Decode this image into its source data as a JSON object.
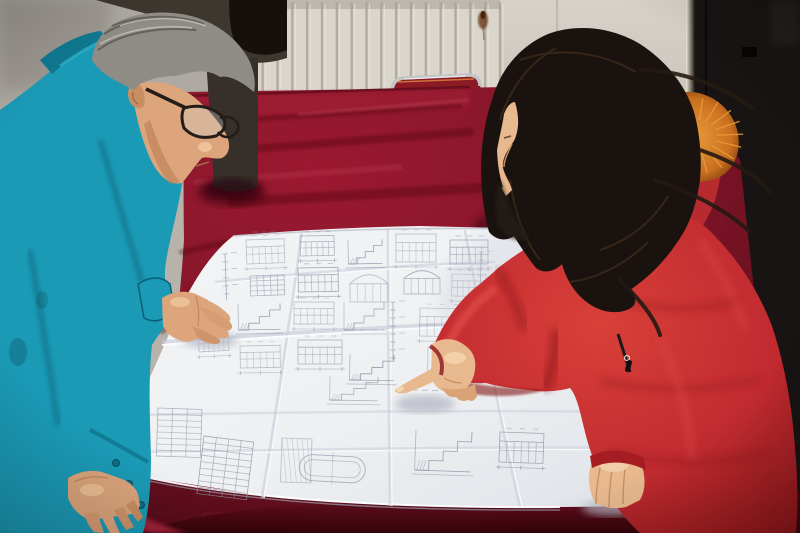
{
  "scene": {
    "kind": "photograph",
    "subjects": [
      "left-worker-teal-jacket",
      "background-worker-dark-jacket",
      "right-worker-red-coat"
    ],
    "action": "reviewing-folded-blueprint-on-red-velvet-table"
  },
  "palette": {
    "wall_left": "#a9a59e",
    "wall_right": "#d0ccc3",
    "wall_line": "#b8b3aa",
    "radiator_base": "#dad6cc",
    "radiator_groove": "#aaa59a",
    "radiator_light": "#e9e5dc",
    "rust": "#6e3f20",
    "door": "#181413",
    "door_edge": "#efe7d4",
    "chair_metal": "#c2c4c6",
    "chair_red": "#8c1a24",
    "chair_glint": "#d8883f",
    "velvet_center": "#9c1930",
    "velvet_edge": "#5a0c1b",
    "velvet_dark": "#3f0711",
    "velvet_mid": "#7e1527",
    "velvet_light": "#c24a5e",
    "velvet_deep": "#350509",
    "edge_bright": "#a1203a",
    "paper": "#eef0f2",
    "paper_shade": "#dfe2e8",
    "crease_shadow": "#c8ccd8",
    "crease_light": "#f9fafc",
    "line": "#8d93a6",
    "teal": "#1b9ab6",
    "teal_light": "#2fb0c9",
    "teal_dark": "#0f7890",
    "teal_deep": "#0a5e74",
    "skin": "#dca57c",
    "skin_light": "#f0c79c",
    "skin_shadow": "#b97a50",
    "hair_gray": "#8f8c86",
    "hair_gray_dark": "#5a5650",
    "hair_black": "#16100d",
    "jacket_dark": "#3e3730",
    "coat": "#c12b30",
    "coat_bright": "#e0504a",
    "coat_deep": "#841317",
    "coat_dark": "#5f0d11",
    "whair": "#1a120e",
    "whair_light": "#43311f",
    "fur": "#c96f1e",
    "fur_light": "#e89b3a",
    "fur_dark": "#7c3d10",
    "wskin": "#e8b98f",
    "wskin_shadow": "#c68f63"
  },
  "radiator": {
    "x": 233,
    "y": 0,
    "w": 267,
    "h": 114,
    "count": 18
  },
  "velvet": {
    "streaks": [
      {
        "x1": 205,
        "y1": 122,
        "x2": 460,
        "y2": 106,
        "w": 5,
        "o": 0.28,
        "c": "dark"
      },
      {
        "x1": 212,
        "y1": 152,
        "x2": 470,
        "y2": 132,
        "w": 8,
        "o": 0.3,
        "c": "dark"
      },
      {
        "x1": 196,
        "y1": 182,
        "x2": 400,
        "y2": 167,
        "w": 6,
        "o": 0.25,
        "c": "light"
      },
      {
        "x1": 232,
        "y1": 202,
        "x2": 480,
        "y2": 188,
        "w": 10,
        "o": 0.3,
        "c": "dark"
      },
      {
        "x1": 300,
        "y1": 114,
        "x2": 468,
        "y2": 100,
        "w": 3,
        "o": 0.35,
        "c": "light"
      },
      {
        "x1": 182,
        "y1": 252,
        "x2": 228,
        "y2": 242,
        "w": 6,
        "o": 0.3,
        "c": "dark"
      },
      {
        "x1": 162,
        "y1": 330,
        "x2": 198,
        "y2": 300,
        "w": 8,
        "o": 0.35,
        "c": "dark"
      },
      {
        "x1": 157,
        "y1": 400,
        "x2": 184,
        "y2": 362,
        "w": 6,
        "o": 0.3,
        "c": "dark"
      },
      {
        "x1": 502,
        "y1": 120,
        "x2": 640,
        "y2": 136,
        "w": 8,
        "o": 0.3,
        "c": "dark"
      },
      {
        "x1": 520,
        "y1": 104,
        "x2": 620,
        "y2": 112,
        "w": 4,
        "o": 0.3,
        "c": "light"
      },
      {
        "x1": 205,
        "y1": 516,
        "x2": 420,
        "y2": 512,
        "w": 8,
        "o": 0.35,
        "c": "mid"
      },
      {
        "x1": 262,
        "y1": 525,
        "x2": 520,
        "y2": 521,
        "w": 6,
        "o": 0.3,
        "c": "dark"
      }
    ]
  },
  "fur_patches": [
    {
      "cx": 697,
      "cy": 136,
      "rx": 44,
      "ry": 36,
      "n": 18
    },
    {
      "cx": 589,
      "cy": 276,
      "rx": 30,
      "ry": 13,
      "n": 12
    }
  ],
  "blueprint": {
    "clusters": [
      {
        "t": "elev",
        "x": 246,
        "y": 240,
        "w": 38,
        "h": 24,
        "r": -2
      },
      {
        "t": "table",
        "x": 250,
        "y": 276,
        "w": 34,
        "h": 20,
        "r": -2,
        "rows": 4,
        "cols": 5
      },
      {
        "t": "stair",
        "x": 238,
        "y": 304,
        "w": 42,
        "h": 26,
        "r": -1
      },
      {
        "t": "elev",
        "x": 240,
        "y": 346,
        "w": 40,
        "h": 22,
        "r": -1
      },
      {
        "t": "elev",
        "x": 300,
        "y": 236,
        "w": 34,
        "h": 20,
        "r": -1
      },
      {
        "t": "elev",
        "x": 298,
        "y": 268,
        "w": 40,
        "h": 24,
        "r": -1
      },
      {
        "t": "elev",
        "x": 294,
        "y": 302,
        "w": 40,
        "h": 22,
        "r": 0
      },
      {
        "t": "elev",
        "x": 298,
        "y": 340,
        "w": 44,
        "h": 24,
        "r": 0
      },
      {
        "t": "stair",
        "x": 348,
        "y": 240,
        "w": 34,
        "h": 24,
        "r": -1
      },
      {
        "t": "arch",
        "x": 350,
        "y": 274,
        "w": 38,
        "h": 28,
        "r": 0
      },
      {
        "t": "stair",
        "x": 344,
        "y": 302,
        "w": 40,
        "h": 28,
        "r": 0
      },
      {
        "t": "stair",
        "x": 350,
        "y": 354,
        "w": 44,
        "h": 26,
        "r": 1
      },
      {
        "t": "elev",
        "x": 396,
        "y": 234,
        "w": 40,
        "h": 28,
        "r": 0
      },
      {
        "t": "arch",
        "x": 404,
        "y": 270,
        "w": 36,
        "h": 24,
        "r": 0
      },
      {
        "t": "col",
        "x": 390,
        "y": 302,
        "h": 58,
        "r": 0
      },
      {
        "t": "elev",
        "x": 420,
        "y": 308,
        "w": 44,
        "h": 28,
        "r": 1
      },
      {
        "t": "stair",
        "x": 428,
        "y": 346,
        "w": 38,
        "h": 26,
        "r": 1
      },
      {
        "t": "elev",
        "x": 450,
        "y": 240,
        "w": 38,
        "h": 24,
        "r": 0
      },
      {
        "t": "elev",
        "x": 452,
        "y": 274,
        "w": 34,
        "h": 22,
        "r": 1
      },
      {
        "t": "stair",
        "x": 330,
        "y": 376,
        "w": 48,
        "h": 24,
        "r": 1
      },
      {
        "t": "col",
        "x": 222,
        "y": 254,
        "h": 46,
        "r": -2
      },
      {
        "t": "elev",
        "x": 198,
        "y": 332,
        "w": 30,
        "h": 20,
        "r": -3
      },
      {
        "t": "table",
        "x": 158,
        "y": 408,
        "w": 44,
        "h": 48,
        "r": 2,
        "rows": 8,
        "cols": 3
      },
      {
        "t": "table",
        "x": 204,
        "y": 436,
        "w": 50,
        "h": 58,
        "r": 7,
        "rows": 9,
        "cols": 4
      },
      {
        "t": "hatch",
        "x": 282,
        "y": 438,
        "w": 30,
        "h": 44,
        "r": 2
      },
      {
        "t": "oval",
        "x": 300,
        "y": 454,
        "w": 66,
        "h": 26,
        "r": 3
      },
      {
        "t": "stair",
        "x": 416,
        "y": 430,
        "w": 56,
        "h": 40,
        "r": 2
      },
      {
        "t": "table",
        "x": 596,
        "y": 438,
        "w": 30,
        "h": 22,
        "r": 2,
        "rows": 4,
        "cols": 3
      },
      {
        "t": "col",
        "x": 478,
        "y": 252,
        "h": 66,
        "r": 1
      },
      {
        "t": "elev",
        "x": 500,
        "y": 432,
        "w": 44,
        "h": 30,
        "r": 2
      },
      {
        "t": "text",
        "x": 252,
        "y": 232,
        "w": 22,
        "r": 0
      },
      {
        "t": "text",
        "x": 360,
        "y": 330,
        "w": 26,
        "r": 0
      },
      {
        "t": "text",
        "x": 412,
        "y": 390,
        "w": 24,
        "r": 1
      }
    ]
  }
}
